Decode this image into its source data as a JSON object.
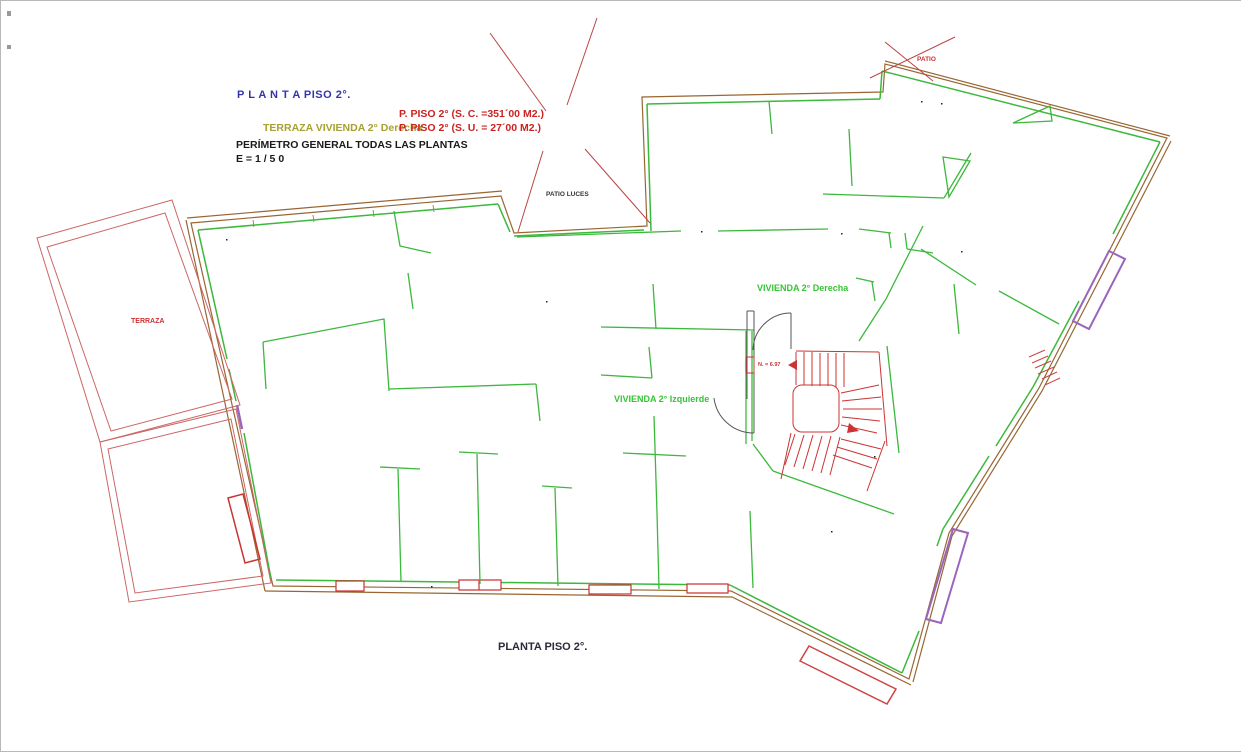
{
  "drawing": {
    "header": {
      "title": "P L A N T A   PISO 2°.",
      "area_constructed": "P. PISO 2° (S. C. =351´00 M2.)",
      "terrace_note": "TERRAZA VIVIENDA 2° Derecha",
      "area_useful": "P. PISO 2° (S. U. = 27´00 M2.)",
      "perimeter_note": "PERÍMETRO GENERAL  TODAS LAS PLANTAS",
      "scale": "E =   1 / 5 0"
    },
    "labels": {
      "patio_luces": "PATIO LUCES",
      "patio": "PATIO",
      "terraza": "TERRAZA",
      "vivienda_derecha": "VIVIENDA 2° Derecha",
      "vivienda_izquierda": "VIVIENDA 2° Izquierde",
      "stair_level": "N. = 6.97",
      "footer": "PLANTA PISO 2°."
    },
    "colors": {
      "walls_green": "#3cb83c",
      "perimeter_brown": "#996633",
      "annotation_red": "#cc3333",
      "terrace_red": "#cc6666",
      "bay_purple": "#9966bb",
      "title_blue": "#3434ad",
      "label_olive": "#a8a030",
      "text_dark": "#1a1a1a"
    }
  }
}
